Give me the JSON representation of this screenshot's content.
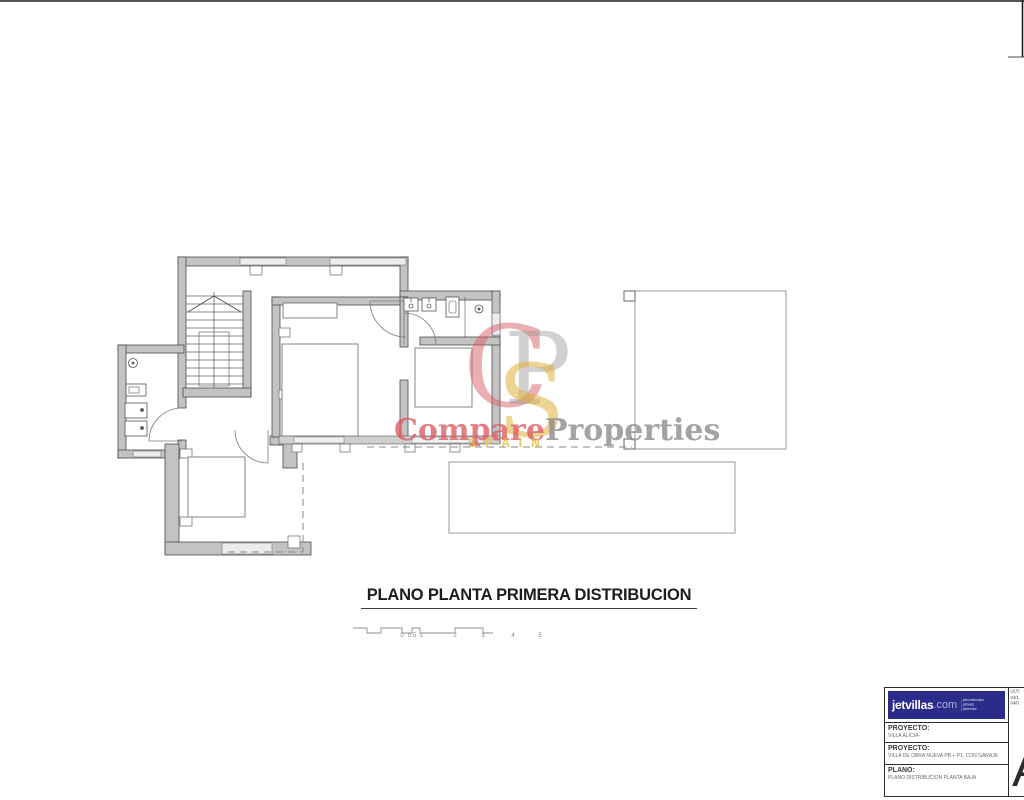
{
  "plan": {
    "title": "PLANO PLANTA PRIMERA DISTRIBUCION"
  },
  "scalebar": {
    "labels": [
      "0",
      "0.5",
      "1",
      "2",
      "3",
      "4",
      "5"
    ]
  },
  "watermark": {
    "monogram": [
      "C",
      "P",
      "S"
    ],
    "compare": "Compare",
    "properties": "Properties",
    "spain": "SPAIN"
  },
  "titleblock": {
    "logo": {
      "brand": "jetvillas",
      "tld": ".com",
      "services": [
        "jetconstruction",
        "jetsales",
        "jetservice"
      ]
    },
    "revision_lines": [
      "ULTI",
      "24/1",
      "04/0"
    ],
    "rows": [
      {
        "label": "PROYECTO:",
        "value": "VILLA ALICIA-"
      },
      {
        "label": "PROYECTO:",
        "value": "VILLA DE OBRA NUEVA PB + P1, CON GARAJE"
      },
      {
        "label": "PLANO:",
        "value": "PLANO DISTRIBUCION PLANTA BAJA"
      }
    ],
    "sheet_letter": "A"
  },
  "colors": {
    "brand_blue": "#2b2b8a",
    "watermark_red": "#dd5f66",
    "watermark_gray": "#8d8d8d",
    "watermark_gold": "#e2b43e",
    "wall_gray": "#c3c3c3"
  }
}
